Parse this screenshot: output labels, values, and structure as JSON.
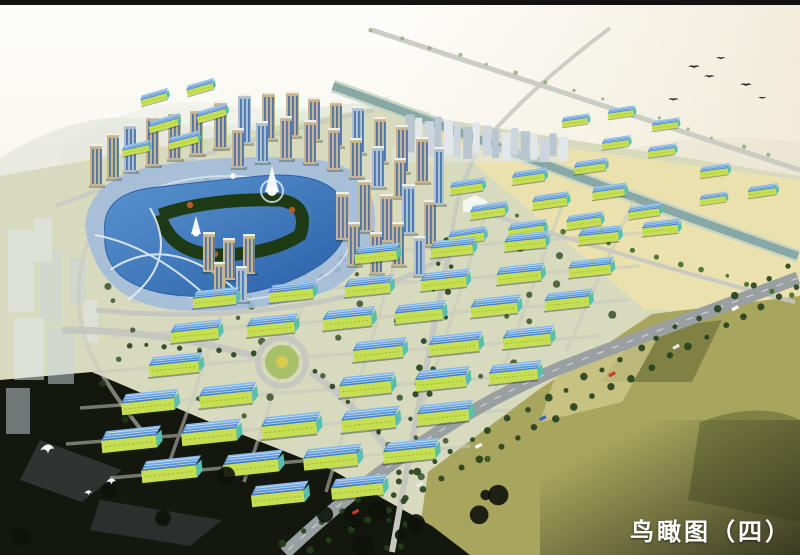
{
  "caption": {
    "text": "鸟瞰图（四）",
    "color": "#ffffff"
  },
  "palette": {
    "frame_bar": "#131313",
    "sky_top": "#fdfdfb",
    "sky_horizon": "#efe9d4",
    "mountain": "#e2e6da",
    "mountain_far": "#ebeee6",
    "ridge_right": "#e9e3d0",
    "land": "#d8dabd",
    "land_yellow": "#ebe2ad",
    "field": "#a8a65e",
    "field_dark": "#75793f",
    "field_light": "#d5cf92",
    "field_corner": "#2c2e1a",
    "foreground": "#14170e",
    "foreground_streak": "#3c4042",
    "river_bank": "#c6d4c4",
    "river_water": "#87a8a4",
    "road": "#c6c8c0",
    "arterial": "#9aa0a2",
    "road_dash": "#e8e8e8",
    "lake_light": "#5b94d0",
    "lake_deep": "#2a60a8",
    "plaza": "#a2bcda",
    "lake_path": "#e4ecf4",
    "island_green": "#1d3a15",
    "roof_light": "#8ec0ee",
    "roof_dark": "#3a7ac6",
    "wall_lime": "#c6de52",
    "wall_teal": "#58bfae",
    "wall_stripe": "#93b32c",
    "tower_tan": "#c9b48c",
    "tower_blue": "#aebfcd",
    "tower_glass": "#3e6fae",
    "tower_cap": "#f0f0ea",
    "distant_a": "#cdd6de",
    "distant_b": "#b9c5d1",
    "distant_c": "#e2e7ec",
    "tree_dark": "#24401b",
    "tree_mid": "#3f6b2e",
    "tree_accent": "#b55a28",
    "tree_blob": "#0d120a",
    "lawn": "#a9c06b",
    "flower": "#d9c94e",
    "bird_dark": "#2a2a2a",
    "bird_white": "#ffffff",
    "white_building": "#f4f6f2",
    "fountain": "#ffffff"
  }
}
